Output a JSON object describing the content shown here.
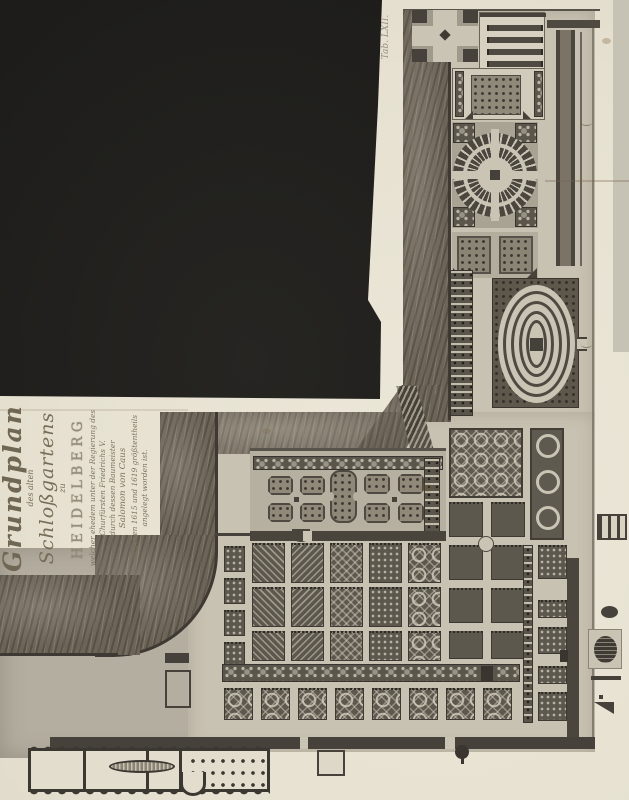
{
  "document": {
    "plate_note": "Tab. LXII."
  },
  "cartouche": {
    "l1": "Grundplan",
    "l2": "des alten",
    "l3": "Schloßgartens",
    "l4": "zu",
    "l5": "HEIDELBERG",
    "l6": "welcher ehedem unter der Regierung des",
    "l7": "Churfürsten Friedrichs V.",
    "l8": "durch dessen Baumeister",
    "l9": "Salomon von Caus",
    "l10": "zwischen 1615 und 1619 größtentheils",
    "l11": "angelegt worden ist."
  },
  "colors": {
    "paper": "#e8e3d4",
    "void_black": "#1d1c1a",
    "engraving_dark": "#4e4a41",
    "engraving_mid": "#8a8475",
    "engraving_light": "#c9c4b3",
    "slope": "#6b6457",
    "ground": "#c8c2b2"
  },
  "garden": {
    "main_grid": {
      "cols": 5,
      "rows": 3
    },
    "right_block": {
      "cols": 2,
      "rows": 4
    },
    "bottom_row": {
      "count": 8
    },
    "left_strip": {
      "count": 4
    },
    "right_beds": {
      "count": 5
    },
    "orangery_bars": {
      "count": 4
    },
    "terrace_beds": {
      "count": 8
    },
    "chain_circles": {
      "count": 3
    },
    "oval_rings": {
      "count": 4
    }
  }
}
